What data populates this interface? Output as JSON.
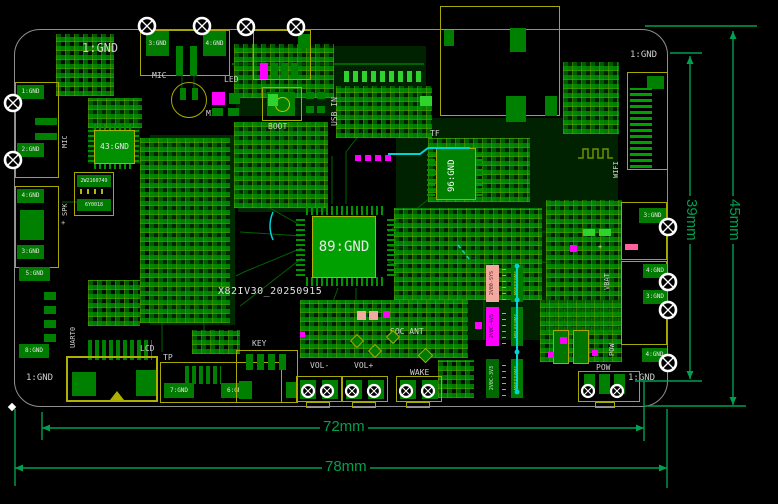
{
  "board": {
    "id_text": "X82IV30_20250915",
    "corner_tl": "1:GND",
    "corner_tr": "1:GND",
    "corner_bl": "1:GND",
    "corner_br": "1:GND"
  },
  "dims": {
    "w_inner": "72mm",
    "w_outer": "78mm",
    "h_inner": "39mm",
    "h_outer": "45mm"
  },
  "chips": {
    "soc": "89:GND",
    "codec": "96:GND",
    "amp": "43:GND"
  },
  "labels": {
    "mic_conn": "MIC",
    "mic_part": "MIC",
    "mic_left": "MIC",
    "led": "LED",
    "boot": "BOOT",
    "usb_in": "USB IN",
    "tf": "TF",
    "wifi": "WIFI",
    "vbat": "VBAT",
    "vbat_plus": "+",
    "vbat_minus": "-",
    "pow_side": "POW",
    "pow_bottom": "POW",
    "wake": "WAKE",
    "vol_minus": "VOL-",
    "vol_plus": "VOL+",
    "key": "KEY",
    "tp": "TP",
    "lcd": "LCD",
    "uart0": "UART0",
    "spk": "SPK",
    "spk_plus": "+",
    "soc_ant": "SOC ANT"
  },
  "pads": {
    "top": [
      "3:GND",
      "4:GND"
    ],
    "left": [
      "1:GND",
      "2:GND",
      "4:GND",
      "3:GND",
      "5:GND",
      "8:GND"
    ],
    "right": [
      "3:GND",
      "4:GND",
      "3:GND",
      "4:GND"
    ],
    "tp": [
      "7:GND",
      "6:GND"
    ]
  },
  "parts": {
    "inductor_top": "2W2160749",
    "inductor_bottom": "6Y0018",
    "rails": [
      {
        "body": "2V00-SYS",
        "pad": "M05S50M4"
      },
      {
        "body": "2V0C-4V5",
        "pad": "M0L650M4"
      },
      {
        "body": "2V0C-3V3",
        "pad": "M05S50M4"
      }
    ]
  },
  "colors": {
    "copper": "#007a00",
    "bright_pad": "#00c000",
    "silk_yellow": "#a8a800",
    "silk_white": "#d0d0d0",
    "magenta": "#ff00ff",
    "salmon": "#f2a9a0",
    "cyan": "#00d5d5",
    "dimension_green": "#00a050",
    "board_outline": "#9a9a9a"
  }
}
